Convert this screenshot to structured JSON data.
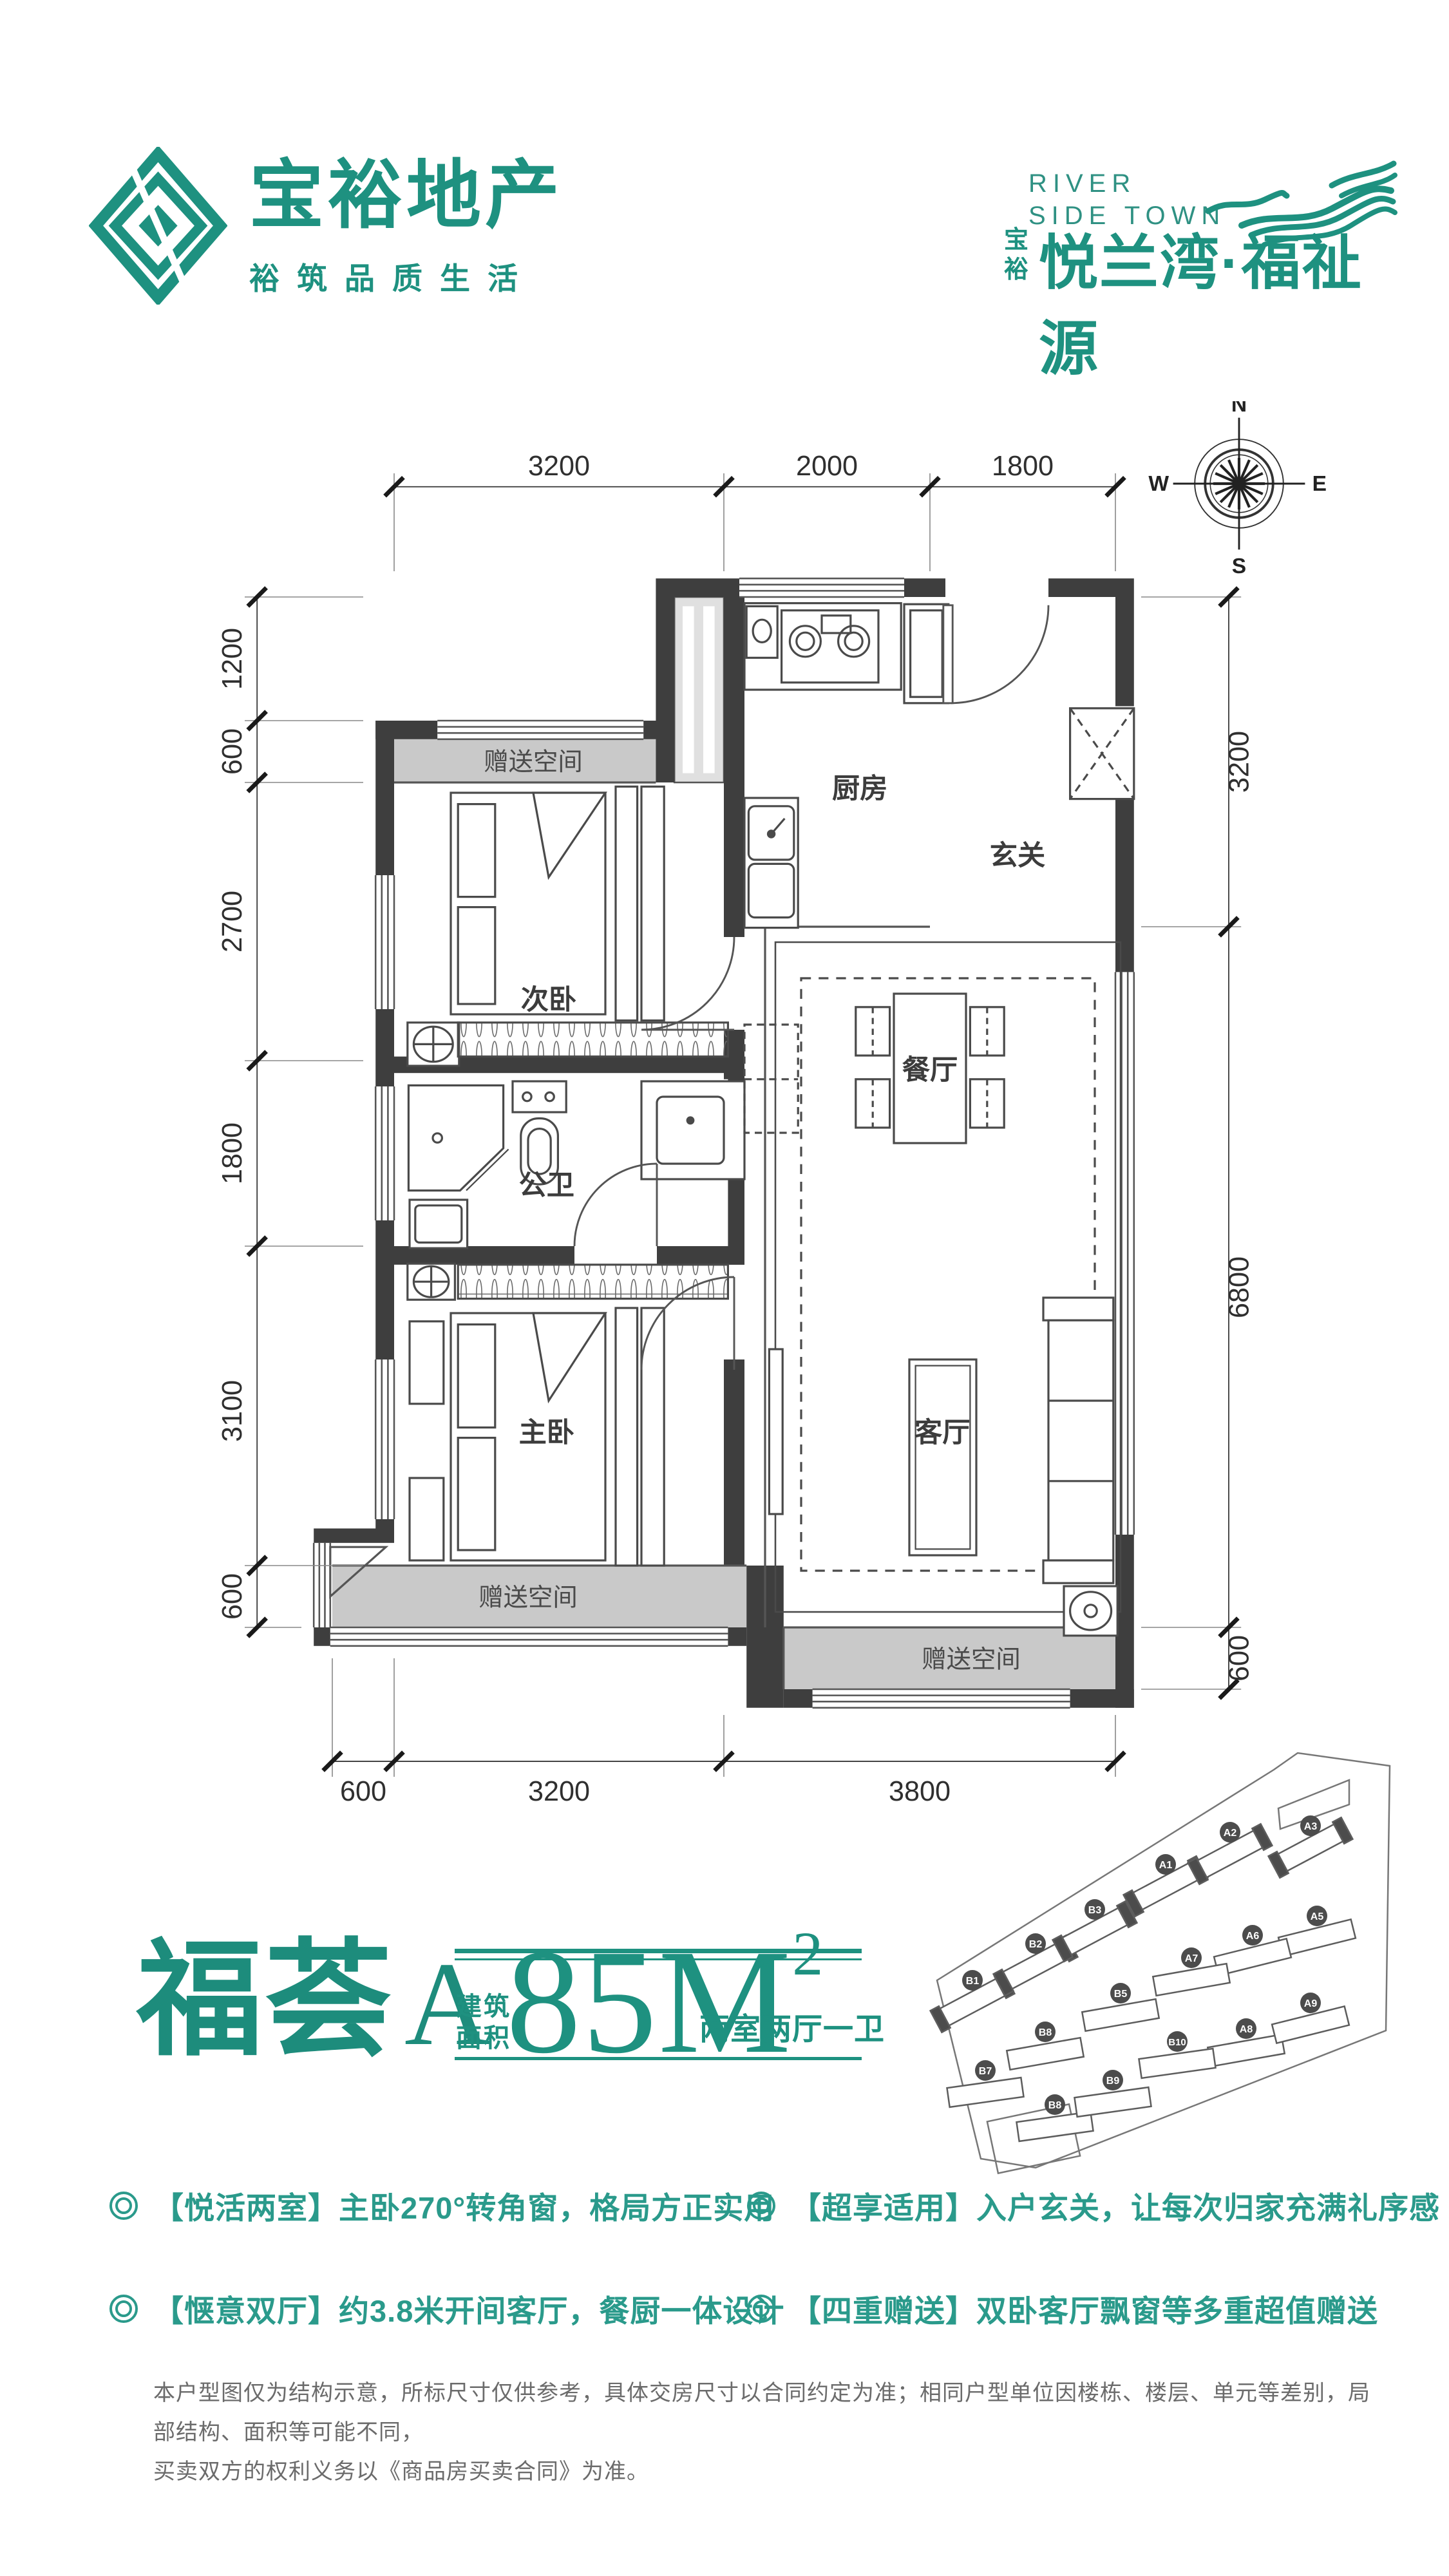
{
  "colors": {
    "accent": "#1e9180",
    "feature_text": "#2a9a8b",
    "wall": "#3e3e3e",
    "gift_fill": "#c9c9c9",
    "shaft_fill": "#e0e0e0",
    "line": "#555555"
  },
  "brand": {
    "name": "宝裕地产",
    "tagline": "裕筑品质生活"
  },
  "project": {
    "en1": "RIVER",
    "en2": "SIDE TOWN",
    "prefix1": "宝",
    "prefix2": "裕",
    "name": "悦兰湾·福祉源"
  },
  "compass": {
    "n": "N",
    "e": "E",
    "s": "S",
    "w": "W"
  },
  "floorplan": {
    "rooms": [
      "次卧",
      "厨房",
      "玄关",
      "餐厅",
      "公卫",
      "主卧",
      "客厅"
    ],
    "gift": "赠送空间",
    "dims": {
      "top": [
        "3200",
        "2000",
        "1800"
      ],
      "left": [
        "1200",
        "600",
        "2700",
        "1800",
        "3100",
        "600"
      ],
      "right": [
        "3200",
        "6800",
        "600"
      ],
      "bottom": [
        "600",
        "3200",
        "3800"
      ]
    }
  },
  "title": {
    "name": "福荟",
    "variant": "A",
    "area_cap1": "建筑",
    "area_cap2": "面积",
    "area_value": "85",
    "area_unit": "M",
    "area_exp": "2",
    "layout": "两室两厅一卫"
  },
  "siteplan": {
    "badges": [
      {
        "label": "A1"
      },
      {
        "label": "A2"
      },
      {
        "label": "A3"
      },
      {
        "label": "A5"
      },
      {
        "label": "A6"
      },
      {
        "label": "A7"
      },
      {
        "label": "A8"
      },
      {
        "label": "A9"
      },
      {
        "label": "B1"
      },
      {
        "label": "B2"
      },
      {
        "label": "B3"
      },
      {
        "label": "B5"
      },
      {
        "label": "B7"
      },
      {
        "label": "B8"
      },
      {
        "label": "B8"
      },
      {
        "label": "B9"
      },
      {
        "label": "B10"
      }
    ]
  },
  "features": [
    {
      "text": "【悦活两室】主卧270°转角窗，格局方正实用"
    },
    {
      "text": "【惬意双厅】约3.8米开间客厅，餐厨一体设计"
    },
    {
      "text": "【超享适用】入户玄关，让每次归家充满礼序感"
    },
    {
      "text": "【四重赠送】双卧客厅飘窗等多重超值赠送"
    }
  ],
  "disclaimer": {
    "line1": "本户型图仅为结构示意，所标尺寸仅供参考，具体交房尺寸以合同约定为准；相同户型单位因楼栋、楼层、单元等差别，局部结构、面积等可能不同，",
    "line2": "买卖双方的权利义务以《商品房买卖合同》为准。"
  }
}
